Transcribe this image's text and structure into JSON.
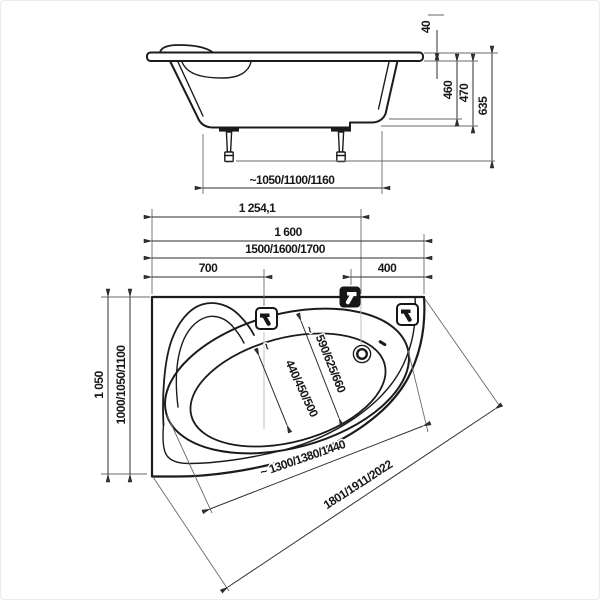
{
  "meta": {
    "type": "technical-dimension-drawing",
    "subject": "asymmetric corner bathtub, side elevation and plan view",
    "units": "mm"
  },
  "colors": {
    "background": "#ffffff",
    "drawing_line": "#1b1b1b",
    "dimension_line": "#2e2e2e",
    "text": "#181818",
    "icon_dark": "#161616"
  },
  "side_view": {
    "labels": {
      "rim_height": "40",
      "depth_inner": "460",
      "depth_outer": "470",
      "overall_height": "635",
      "feet_spacing": "~1050/1100/1160"
    }
  },
  "plan_view": {
    "labels": {
      "drain_offset": "1 254,1",
      "overall_length": "1 600",
      "length_variants": "1500/1600/1700",
      "faucet_offset_left": "700",
      "faucet_offset_right": "400",
      "overall_width": "1 050",
      "width_variants": "1000/1050/1100",
      "approx_sign": "~",
      "inner_width_seat": "440/450/500",
      "inner_width_main": "590/625/660",
      "inner_length": "~ 1300/1380/1440",
      "front_edge_length": "1801/1911/2022"
    },
    "icons": {
      "dark_square": "water-supply-position-icon",
      "light_square": "faucet-position-icon"
    }
  }
}
